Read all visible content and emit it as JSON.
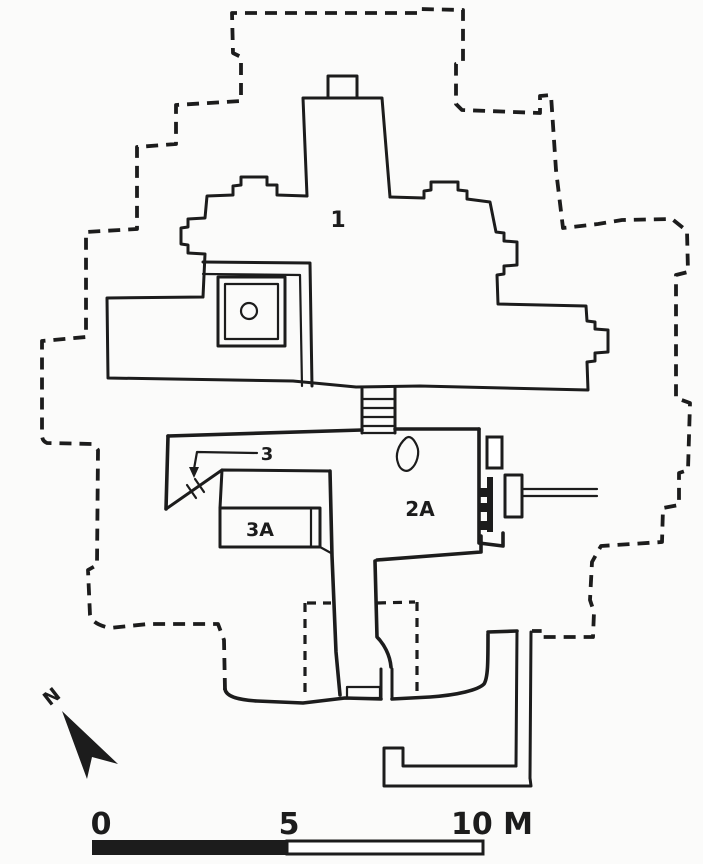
{
  "colors": {
    "ink": "#1c1c1c",
    "paper": "#fbfbfa"
  },
  "plan": {
    "label_main_shrine": "1",
    "label_room_2a": "2A",
    "label_door_3": "3",
    "label_room_3a": "3A"
  },
  "north_indicator": {
    "label": "N"
  },
  "scale_bar": {
    "tick_start": "0",
    "tick_mid": "5",
    "tick_end": "10 M"
  }
}
